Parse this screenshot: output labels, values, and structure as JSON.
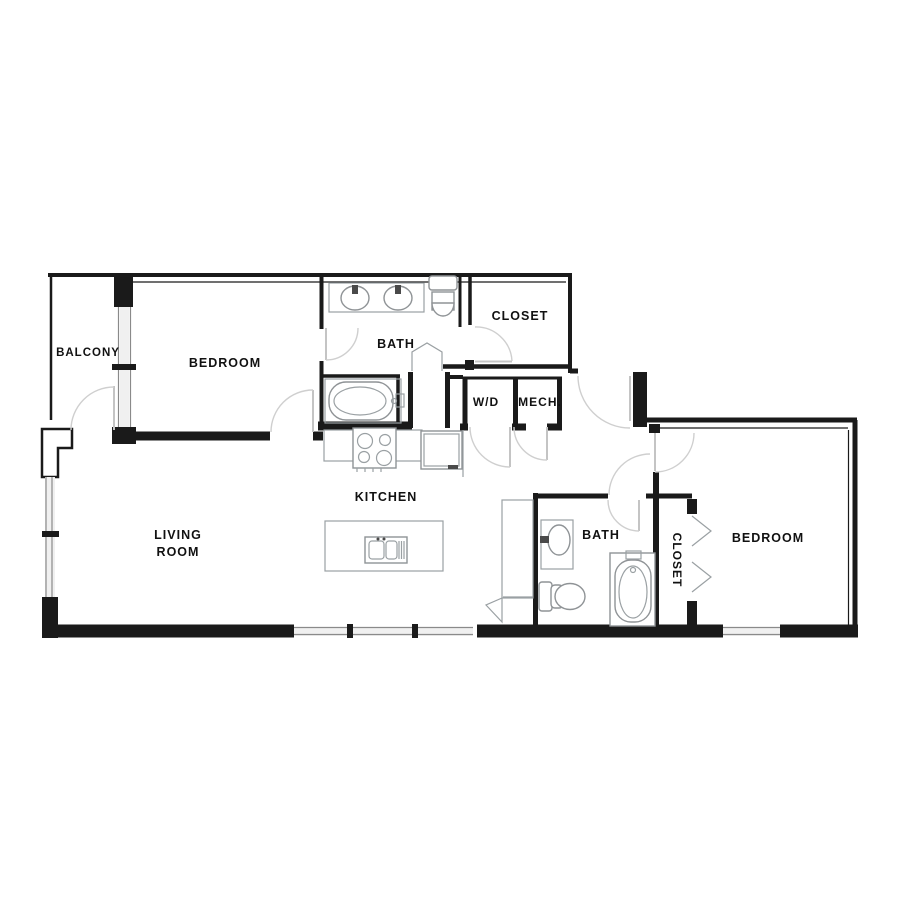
{
  "floor_plan": {
    "type": "apartment-floor-plan",
    "rooms": {
      "balcony": "BALCONY",
      "bedroom_1": "BEDROOM",
      "bath_1": "BATH",
      "closet_1": "CLOSET",
      "laundry": "W/D",
      "mechanical": "MECH.",
      "kitchen": "KITCHEN",
      "living_room_line_1": "LIVING",
      "living_room_line_2": "ROOM",
      "bath_2": "BATH",
      "closet_2": "CLOSET",
      "bedroom_2": "BEDROOM"
    },
    "fixtures": [
      "double-vanity-sinks",
      "toilet-1",
      "bathtub-1",
      "stove",
      "refrigerator",
      "kitchen-island",
      "island-sink",
      "vanity-sink-2",
      "toilet-2",
      "bathtub-2",
      "bifold-closet-doors",
      "sliding-balcony-door",
      "windows",
      "door-swings"
    ],
    "colors": {
      "wall": "#1a1a1a",
      "fixture_line": "#8f9396",
      "door_swing": "#cfcfcf",
      "window_line": "#8a8a8a",
      "window_fill": "#f0f0f0",
      "label": "#111111",
      "background": "#ffffff"
    }
  }
}
